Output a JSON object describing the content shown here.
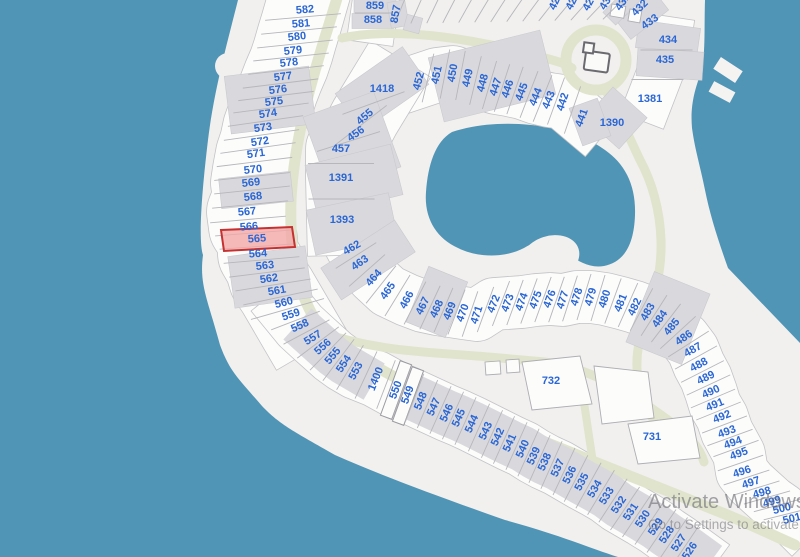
{
  "map": {
    "colors": {
      "water": "#5095b5",
      "land": "#f1f0ee",
      "road": "#e0e4cc",
      "building": "#d9d9dd",
      "lot_fill": "#fcfcfb",
      "lot_line": "#b6b6bb",
      "band_edge": "#c3c3c7",
      "label": "#2a66d5",
      "highlight_fill": "#f2a7a7",
      "highlight_stroke": "#c53030"
    },
    "selected_lot": {
      "label": "565",
      "points": "221,230 292,227 295,247 224,251"
    },
    "lots": [
      {
        "label": "582",
        "x": 305,
        "y": 10,
        "r": -5
      },
      {
        "label": "581",
        "x": 301,
        "y": 24,
        "r": -5
      },
      {
        "label": "580",
        "x": 297,
        "y": 37,
        "r": -6
      },
      {
        "label": "579",
        "x": 293,
        "y": 51,
        "r": -6
      },
      {
        "label": "578",
        "x": 289,
        "y": 63,
        "r": -6
      },
      {
        "label": "577",
        "x": 283,
        "y": 77,
        "r": -7
      },
      {
        "label": "576",
        "x": 278,
        "y": 90,
        "r": -7
      },
      {
        "label": "575",
        "x": 274,
        "y": 102,
        "r": -7
      },
      {
        "label": "574",
        "x": 268,
        "y": 114,
        "r": -8
      },
      {
        "label": "573",
        "x": 263,
        "y": 128,
        "r": -8
      },
      {
        "label": "572",
        "x": 260,
        "y": 142,
        "r": -8
      },
      {
        "label": "571",
        "x": 256,
        "y": 154,
        "r": -8
      },
      {
        "label": "570",
        "x": 253,
        "y": 170,
        "r": -6
      },
      {
        "label": "569",
        "x": 251,
        "y": 183,
        "r": -6
      },
      {
        "label": "568",
        "x": 253,
        "y": 197,
        "r": -6
      },
      {
        "label": "567",
        "x": 247,
        "y": 212,
        "r": -5
      },
      {
        "label": "566",
        "x": 249,
        "y": 227,
        "r": -5
      },
      {
        "label": "565",
        "x": 257,
        "y": 239,
        "r": -4
      },
      {
        "label": "564",
        "x": 258,
        "y": 254,
        "r": -4
      },
      {
        "label": "563",
        "x": 265,
        "y": 266,
        "r": -6
      },
      {
        "label": "562",
        "x": 269,
        "y": 279,
        "r": -8
      },
      {
        "label": "561",
        "x": 277,
        "y": 291,
        "r": -10
      },
      {
        "label": "560",
        "x": 284,
        "y": 303,
        "r": -14
      },
      {
        "label": "559",
        "x": 291,
        "y": 315,
        "r": -18
      },
      {
        "label": "558",
        "x": 300,
        "y": 326,
        "r": -24
      },
      {
        "label": "557",
        "x": 313,
        "y": 338,
        "r": -32
      },
      {
        "label": "556",
        "x": 323,
        "y": 347,
        "r": -42
      },
      {
        "label": "555",
        "x": 333,
        "y": 356,
        "r": -50
      },
      {
        "label": "554",
        "x": 344,
        "y": 364,
        "r": -56
      },
      {
        "label": "553",
        "x": 356,
        "y": 371,
        "r": -62
      },
      {
        "label": "1400",
        "x": 376,
        "y": 379,
        "r": -68
      },
      {
        "label": "550",
        "x": 396,
        "y": 390,
        "r": -70
      },
      {
        "label": "549",
        "x": 408,
        "y": 395,
        "r": -70
      },
      {
        "label": "548",
        "x": 421,
        "y": 401,
        "r": -68
      },
      {
        "label": "547",
        "x": 434,
        "y": 407,
        "r": -66
      },
      {
        "label": "546",
        "x": 447,
        "y": 413,
        "r": -66
      },
      {
        "label": "545",
        "x": 459,
        "y": 418,
        "r": -66
      },
      {
        "label": "544",
        "x": 472,
        "y": 424,
        "r": -66
      },
      {
        "label": "543",
        "x": 486,
        "y": 431,
        "r": -66
      },
      {
        "label": "542",
        "x": 498,
        "y": 437,
        "r": -66
      },
      {
        "label": "541",
        "x": 510,
        "y": 443,
        "r": -66
      },
      {
        "label": "540",
        "x": 523,
        "y": 449,
        "r": -66
      },
      {
        "label": "539",
        "x": 534,
        "y": 456,
        "r": -66
      },
      {
        "label": "538",
        "x": 545,
        "y": 462,
        "r": -66
      },
      {
        "label": "537",
        "x": 558,
        "y": 468,
        "r": -66
      },
      {
        "label": "536",
        "x": 570,
        "y": 475,
        "r": -64
      },
      {
        "label": "535",
        "x": 582,
        "y": 482,
        "r": -62
      },
      {
        "label": "534",
        "x": 595,
        "y": 489,
        "r": -60
      },
      {
        "label": "533",
        "x": 607,
        "y": 496,
        "r": -58
      },
      {
        "label": "532",
        "x": 619,
        "y": 505,
        "r": -56
      },
      {
        "label": "531",
        "x": 631,
        "y": 512,
        "r": -56
      },
      {
        "label": "530",
        "x": 643,
        "y": 519,
        "r": -56
      },
      {
        "label": "529",
        "x": 656,
        "y": 527,
        "r": -56
      },
      {
        "label": "528",
        "x": 667,
        "y": 535,
        "r": -56
      },
      {
        "label": "527",
        "x": 679,
        "y": 543,
        "r": -56
      },
      {
        "label": "526",
        "x": 690,
        "y": 551,
        "r": -56
      },
      {
        "label": "859",
        "x": 375,
        "y": 6,
        "r": 0
      },
      {
        "label": "858",
        "x": 373,
        "y": 20,
        "r": 0
      },
      {
        "label": "857",
        "x": 396,
        "y": 14,
        "r": -80
      },
      {
        "label": "1418",
        "x": 382,
        "y": 89,
        "r": 0
      },
      {
        "label": "455",
        "x": 365,
        "y": 117,
        "r": -40
      },
      {
        "label": "456",
        "x": 356,
        "y": 134,
        "r": -35
      },
      {
        "label": "457",
        "x": 341,
        "y": 149,
        "r": 0
      },
      {
        "label": "1391",
        "x": 341,
        "y": 178,
        "r": 0
      },
      {
        "label": "1393",
        "x": 342,
        "y": 220,
        "r": 0
      },
      {
        "label": "452",
        "x": 419,
        "y": 81,
        "r": -75
      },
      {
        "label": "451",
        "x": 437,
        "y": 75,
        "r": -78
      },
      {
        "label": "450",
        "x": 453,
        "y": 73,
        "r": -80
      },
      {
        "label": "449",
        "x": 468,
        "y": 78,
        "r": -78
      },
      {
        "label": "448",
        "x": 483,
        "y": 83,
        "r": -75
      },
      {
        "label": "447",
        "x": 496,
        "y": 87,
        "r": -72
      },
      {
        "label": "446",
        "x": 508,
        "y": 89,
        "r": -72
      },
      {
        "label": "445",
        "x": 522,
        "y": 92,
        "r": -70
      },
      {
        "label": "444",
        "x": 536,
        "y": 97,
        "r": -68
      },
      {
        "label": "443",
        "x": 549,
        "y": 100,
        "r": -68
      },
      {
        "label": "442",
        "x": 563,
        "y": 102,
        "r": -72
      },
      {
        "label": "441",
        "x": 582,
        "y": 118,
        "r": -70
      },
      {
        "label": "1390",
        "x": 612,
        "y": 123,
        "r": 0
      },
      {
        "label": "1381",
        "x": 650,
        "y": 99,
        "r": 0
      },
      {
        "label": "435",
        "x": 665,
        "y": 60,
        "r": 0
      },
      {
        "label": "434",
        "x": 668,
        "y": 40,
        "r": 0
      },
      {
        "label": "433",
        "x": 650,
        "y": 22,
        "r": -35
      },
      {
        "label": "432",
        "x": 640,
        "y": 8,
        "r": -45
      },
      {
        "label": "431",
        "x": 623,
        "y": 2,
        "r": -55
      },
      {
        "label": "430",
        "x": 607,
        "y": 1,
        "r": -60
      },
      {
        "label": "429",
        "x": 590,
        "y": 2,
        "r": -62
      },
      {
        "label": "428",
        "x": 573,
        "y": 1,
        "r": -64
      },
      {
        "label": "427",
        "x": 556,
        "y": 1,
        "r": -66
      },
      {
        "label": "462",
        "x": 352,
        "y": 248,
        "r": -30
      },
      {
        "label": "463",
        "x": 360,
        "y": 263,
        "r": -35
      },
      {
        "label": "464",
        "x": 374,
        "y": 278,
        "r": -48
      },
      {
        "label": "465",
        "x": 388,
        "y": 291,
        "r": -55
      },
      {
        "label": "466",
        "x": 407,
        "y": 300,
        "r": -62
      },
      {
        "label": "467",
        "x": 423,
        "y": 306,
        "r": -64
      },
      {
        "label": "468",
        "x": 437,
        "y": 309,
        "r": -66
      },
      {
        "label": "469",
        "x": 450,
        "y": 311,
        "r": -68
      },
      {
        "label": "470",
        "x": 463,
        "y": 313,
        "r": -70
      },
      {
        "label": "471",
        "x": 477,
        "y": 315,
        "r": -72
      },
      {
        "label": "472",
        "x": 494,
        "y": 304,
        "r": -68
      },
      {
        "label": "473",
        "x": 508,
        "y": 303,
        "r": -70
      },
      {
        "label": "474",
        "x": 522,
        "y": 302,
        "r": -70
      },
      {
        "label": "475",
        "x": 536,
        "y": 300,
        "r": -70
      },
      {
        "label": "476",
        "x": 550,
        "y": 299,
        "r": -70
      },
      {
        "label": "477",
        "x": 563,
        "y": 300,
        "r": -72
      },
      {
        "label": "478",
        "x": 577,
        "y": 297,
        "r": -72
      },
      {
        "label": "479",
        "x": 591,
        "y": 297,
        "r": -74
      },
      {
        "label": "480",
        "x": 605,
        "y": 299,
        "r": -72
      },
      {
        "label": "481",
        "x": 621,
        "y": 303,
        "r": -68
      },
      {
        "label": "482",
        "x": 635,
        "y": 307,
        "r": -64
      },
      {
        "label": "483",
        "x": 648,
        "y": 312,
        "r": -60
      },
      {
        "label": "484",
        "x": 660,
        "y": 319,
        "r": -55
      },
      {
        "label": "485",
        "x": 672,
        "y": 327,
        "r": -50
      },
      {
        "label": "486",
        "x": 684,
        "y": 338,
        "r": -35
      },
      {
        "label": "487",
        "x": 693,
        "y": 350,
        "r": -30
      },
      {
        "label": "488",
        "x": 699,
        "y": 365,
        "r": -28
      },
      {
        "label": "489",
        "x": 706,
        "y": 378,
        "r": -26
      },
      {
        "label": "490",
        "x": 711,
        "y": 392,
        "r": -24
      },
      {
        "label": "491",
        "x": 715,
        "y": 405,
        "r": -22
      },
      {
        "label": "492",
        "x": 722,
        "y": 417,
        "r": -22
      },
      {
        "label": "493",
        "x": 727,
        "y": 432,
        "r": -20
      },
      {
        "label": "494",
        "x": 733,
        "y": 443,
        "r": -20
      },
      {
        "label": "495",
        "x": 739,
        "y": 454,
        "r": -20
      },
      {
        "label": "496",
        "x": 742,
        "y": 472,
        "r": -18
      },
      {
        "label": "497",
        "x": 751,
        "y": 483,
        "r": -18
      },
      {
        "label": "498",
        "x": 762,
        "y": 493,
        "r": -16
      },
      {
        "label": "499",
        "x": 772,
        "y": 502,
        "r": -16
      },
      {
        "label": "500",
        "x": 782,
        "y": 509,
        "r": -14
      },
      {
        "label": "501",
        "x": 792,
        "y": 519,
        "r": -14
      },
      {
        "label": "732",
        "x": 551,
        "y": 381,
        "r": 0
      },
      {
        "label": "731",
        "x": 652,
        "y": 437,
        "r": 0
      }
    ]
  },
  "watermark": {
    "line1": "Activate Windows",
    "line2": "Go to Settings to activate"
  }
}
